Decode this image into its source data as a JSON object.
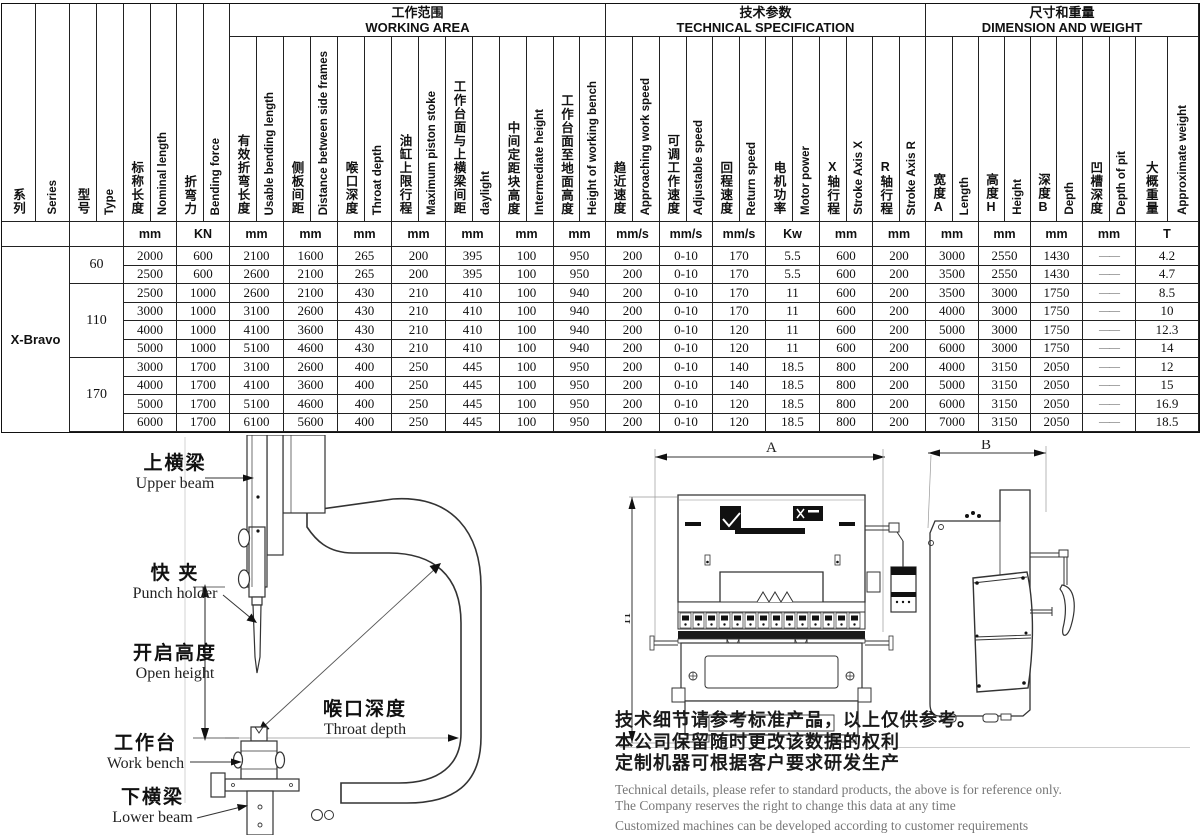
{
  "table": {
    "groups": [
      {
        "cn": "工作范围",
        "en": "WORKING AREA"
      },
      {
        "cn": "技术参数",
        "en": "TECHNICAL SPECIFICATION"
      },
      {
        "cn": "尺寸和重量",
        "en": "DIMENSION AND WEIGHT"
      }
    ],
    "columns": [
      {
        "cn": "系列",
        "en": "Series",
        "unit": ""
      },
      {
        "cn": "型号",
        "en": "Type",
        "unit": ""
      },
      {
        "cn": "标称长度",
        "en": "Nominal length",
        "unit": "mm"
      },
      {
        "cn": "折弯力",
        "en": "Bending force",
        "unit": "KN"
      },
      {
        "cn": "有效折弯长度",
        "en": "Usable bending length",
        "unit": "mm"
      },
      {
        "cn": "侧板间距",
        "en": "Distance between side frames",
        "unit": "mm"
      },
      {
        "cn": "喉口深度",
        "en": "Throat depth",
        "unit": "mm"
      },
      {
        "cn": "油缸上限行程",
        "en": "Maximum piston stoke",
        "unit": "mm"
      },
      {
        "cn": "工作台面与上横梁间距",
        "en": "daylight",
        "unit": "mm"
      },
      {
        "cn": "中间定距块高度",
        "en": "Intermediate height",
        "unit": "mm"
      },
      {
        "cn": "工作台面至地面高度",
        "en": "Height of working bench",
        "unit": "mm"
      },
      {
        "cn": "趋近速度",
        "en": "Approaching work speed",
        "unit": "mm/s"
      },
      {
        "cn": "可调工作速度",
        "en": "Adjustable speed",
        "unit": "mm/s"
      },
      {
        "cn": "回程速度",
        "en": "Return speed",
        "unit": "mm/s"
      },
      {
        "cn": "电机功率",
        "en": "Motor power",
        "unit": "Kw"
      },
      {
        "cn": "X轴行程",
        "en": "Stroke Axis X",
        "unit": "mm"
      },
      {
        "cn": "R轴行程",
        "en": "Stroke Axis R",
        "unit": "mm"
      },
      {
        "cn": "宽度A",
        "en": "Length",
        "unit": "mm"
      },
      {
        "cn": "高度H",
        "en": "Height",
        "unit": "mm"
      },
      {
        "cn": "深度B",
        "en": "Depth",
        "unit": "mm"
      },
      {
        "cn": "凹槽深度",
        "en": "Depth of pit",
        "unit": "mm"
      },
      {
        "cn": "大概重量",
        "en": "Approximate weight",
        "unit": "T"
      }
    ],
    "series": "X-Bravo",
    "type_groups": [
      {
        "label": "60",
        "rows": 2
      },
      {
        "label": "110",
        "rows": 4
      },
      {
        "label": "170",
        "rows": 4
      }
    ],
    "rows": [
      [
        "2000",
        "600",
        "2100",
        "1600",
        "265",
        "200",
        "395",
        "100",
        "950",
        "200",
        "0-10",
        "170",
        "5.5",
        "600",
        "200",
        "3000",
        "2550",
        "1430",
        "——",
        "4.2"
      ],
      [
        "2500",
        "600",
        "2600",
        "2100",
        "265",
        "200",
        "395",
        "100",
        "950",
        "200",
        "0-10",
        "170",
        "5.5",
        "600",
        "200",
        "3500",
        "2550",
        "1430",
        "——",
        "4.7"
      ],
      [
        "2500",
        "1000",
        "2600",
        "2100",
        "430",
        "210",
        "410",
        "100",
        "940",
        "200",
        "0-10",
        "170",
        "11",
        "600",
        "200",
        "3500",
        "3000",
        "1750",
        "——",
        "8.5"
      ],
      [
        "3000",
        "1000",
        "3100",
        "2600",
        "430",
        "210",
        "410",
        "100",
        "940",
        "200",
        "0-10",
        "170",
        "11",
        "600",
        "200",
        "4000",
        "3000",
        "1750",
        "——",
        "10"
      ],
      [
        "4000",
        "1000",
        "4100",
        "3600",
        "430",
        "210",
        "410",
        "100",
        "940",
        "200",
        "0-10",
        "120",
        "11",
        "600",
        "200",
        "5000",
        "3000",
        "1750",
        "——",
        "12.3"
      ],
      [
        "5000",
        "1000",
        "5100",
        "4600",
        "430",
        "210",
        "410",
        "100",
        "940",
        "200",
        "0-10",
        "120",
        "11",
        "600",
        "200",
        "6000",
        "3000",
        "1750",
        "——",
        "14"
      ],
      [
        "3000",
        "1700",
        "3100",
        "2600",
        "400",
        "250",
        "445",
        "100",
        "950",
        "200",
        "0-10",
        "140",
        "18.5",
        "800",
        "200",
        "4000",
        "3150",
        "2050",
        "——",
        "12"
      ],
      [
        "4000",
        "1700",
        "4100",
        "3600",
        "400",
        "250",
        "445",
        "100",
        "950",
        "200",
        "0-10",
        "140",
        "18.5",
        "800",
        "200",
        "5000",
        "3150",
        "2050",
        "——",
        "15"
      ],
      [
        "5000",
        "1700",
        "5100",
        "4600",
        "400",
        "250",
        "445",
        "100",
        "950",
        "200",
        "0-10",
        "120",
        "18.5",
        "800",
        "200",
        "6000",
        "3150",
        "2050",
        "——",
        "16.9"
      ],
      [
        "6000",
        "1700",
        "6100",
        "5600",
        "400",
        "250",
        "445",
        "100",
        "950",
        "200",
        "0-10",
        "120",
        "18.5",
        "800",
        "200",
        "7000",
        "3150",
        "2050",
        "——",
        "18.5"
      ]
    ]
  },
  "cframe": {
    "labels": {
      "upper_beam": {
        "cn": "上横梁",
        "en": "Upper beam"
      },
      "punch_holder": {
        "cn": "快 夹",
        "en": "Punch holder"
      },
      "open_height": {
        "cn": "开启高度",
        "en": "Open height"
      },
      "throat_depth": {
        "cn": "喉口深度",
        "en": "Throat depth"
      },
      "work_bench": {
        "cn": "工作台",
        "en": "Work bench"
      },
      "lower_beam": {
        "cn": "下横梁",
        "en": "Lower beam"
      }
    }
  },
  "machine": {
    "dim_a": "A",
    "dim_b": "B",
    "dim_h": "H"
  },
  "disclaimer": {
    "cn": [
      "技术细节请参考标准产品，以上仅供参考。",
      "本公司保留随时更改该数据的权利",
      "定制机器可根据客户要求研发生产"
    ],
    "en": [
      "Technical details, please refer to standard products, the above is for reference only.",
      "The Company reserves the right to change this data at any time",
      "Customized machines can be developed according to customer requirements"
    ]
  }
}
